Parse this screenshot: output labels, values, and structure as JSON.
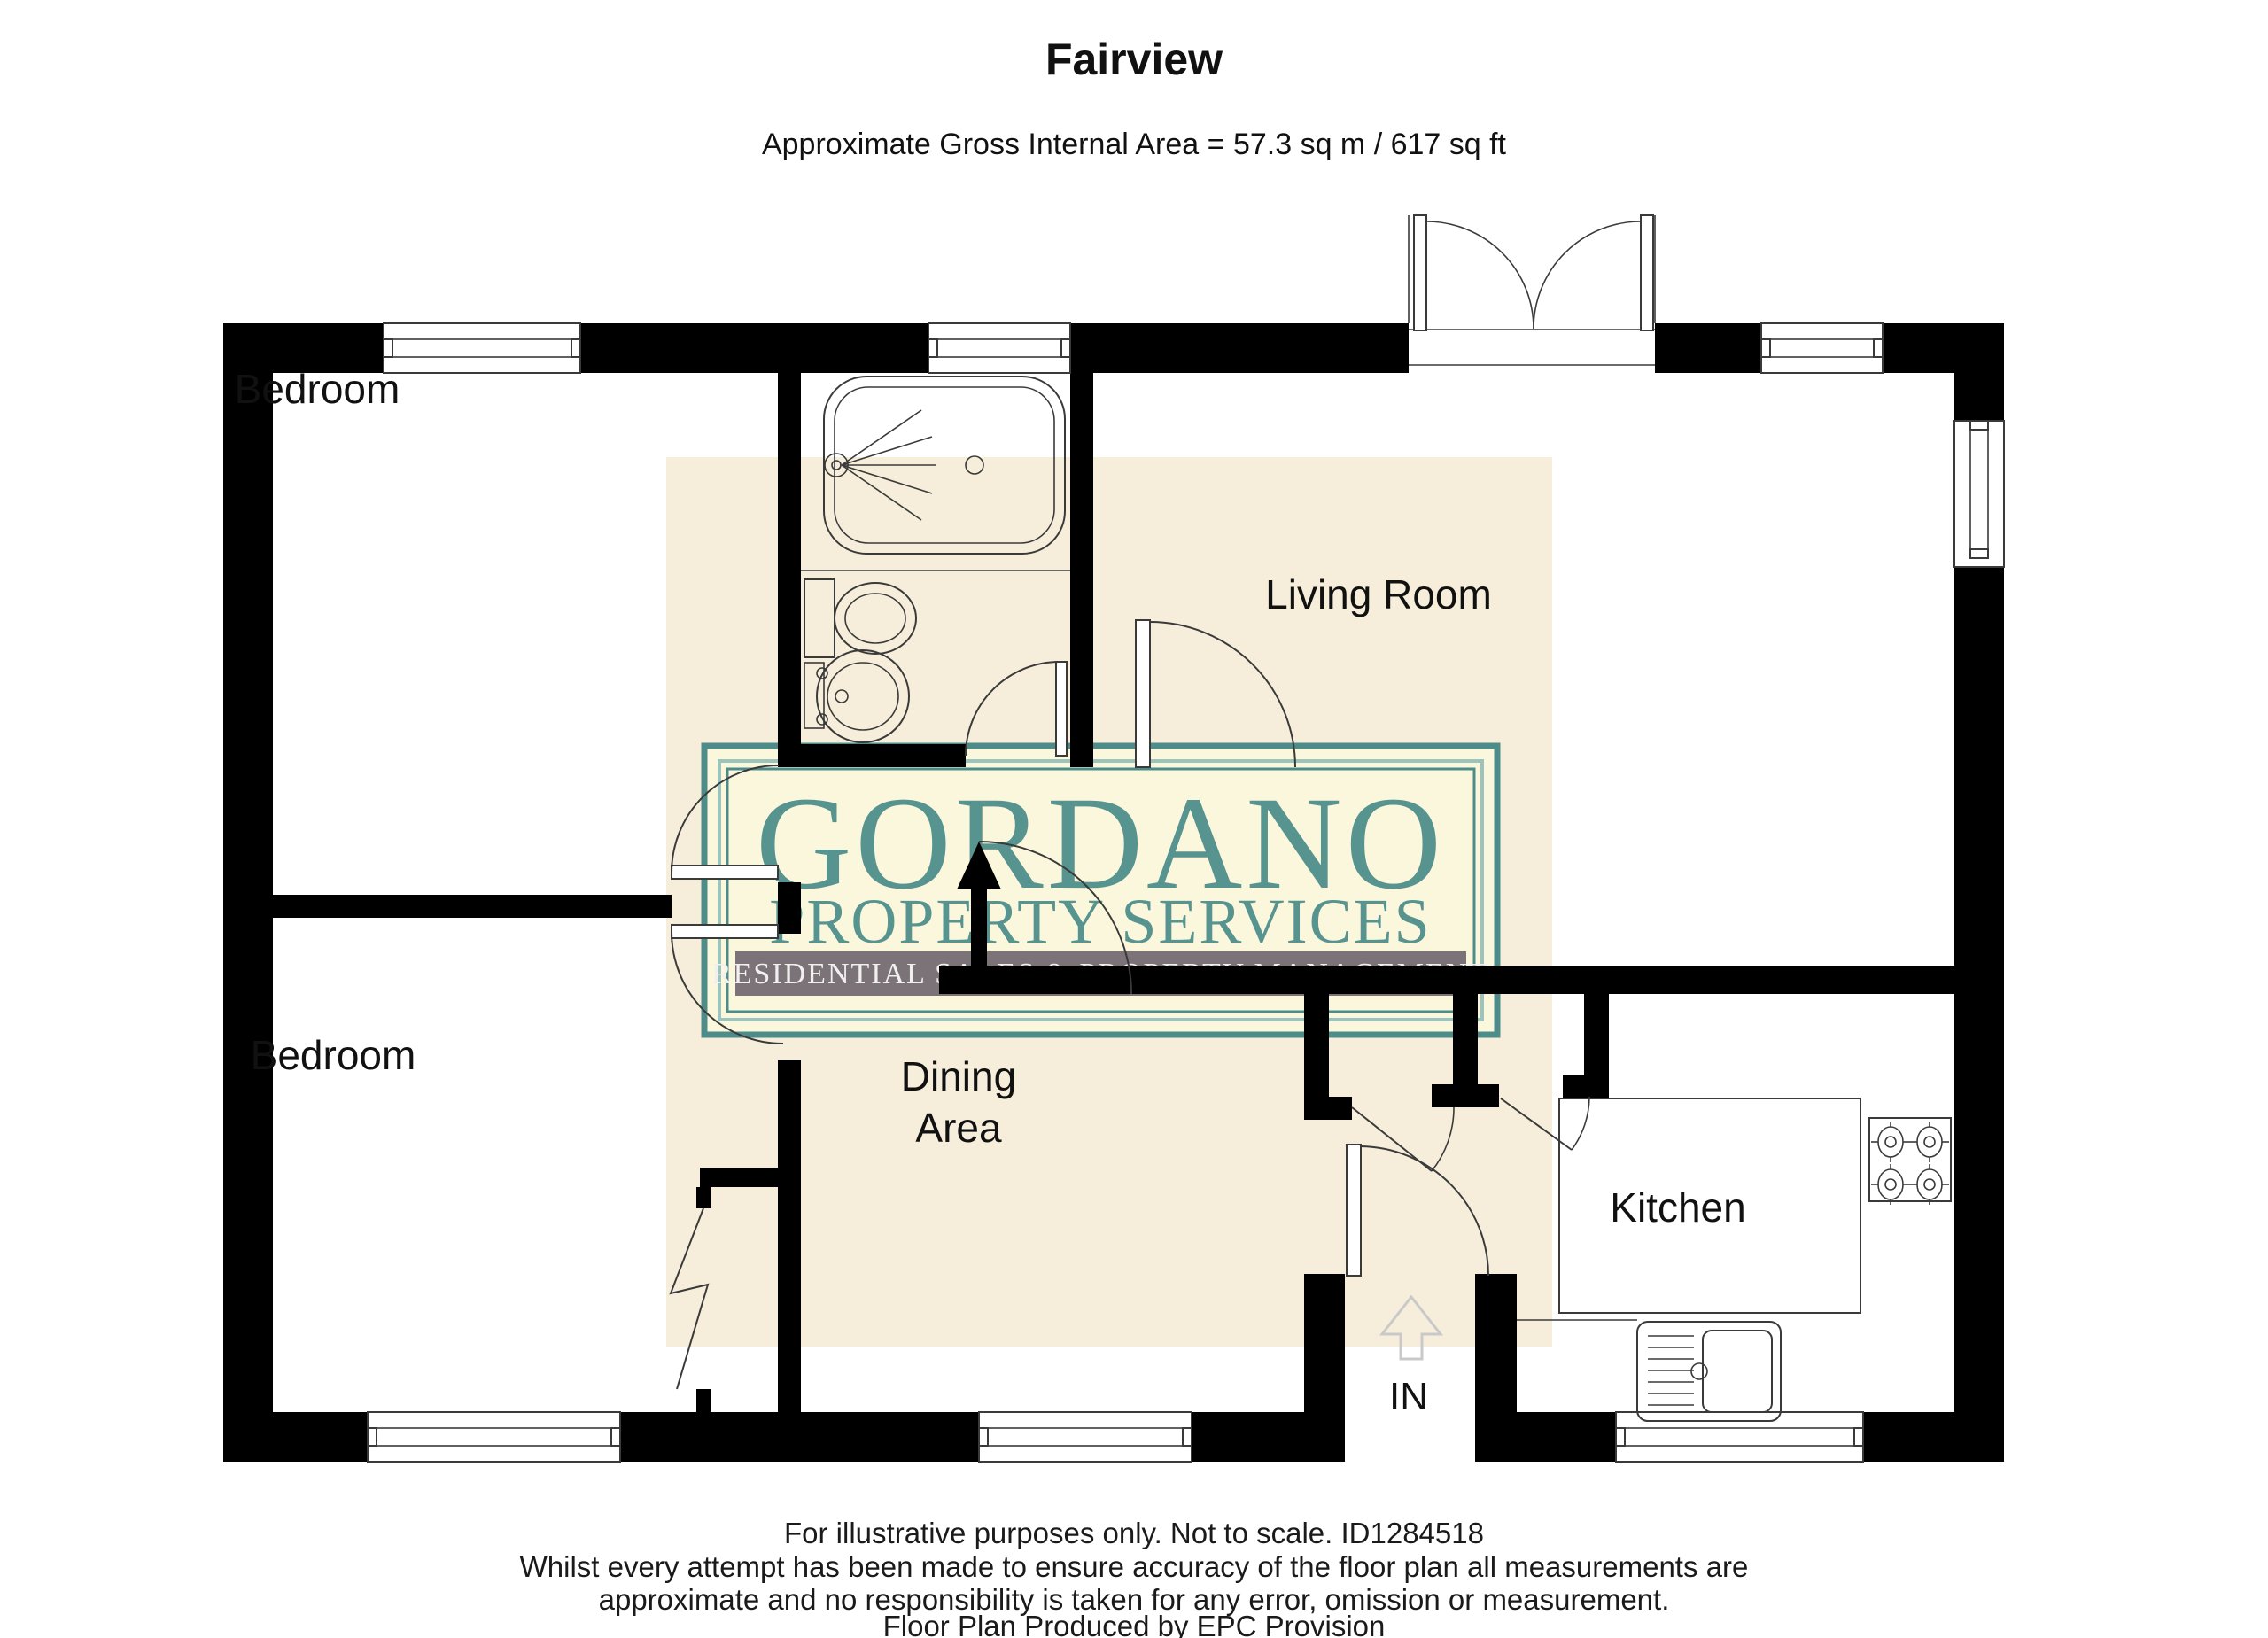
{
  "title": "Fairview",
  "subtitle": "Approximate Gross Internal Area = 57.3 sq m / 617 sq ft",
  "rooms": {
    "bedroom_top": "Bedroom",
    "bedroom_bottom": "Bedroom",
    "living_room": "Living Room",
    "dining_line1": "Dining",
    "dining_line2": "Area",
    "kitchen": "Kitchen",
    "entrance": "IN"
  },
  "watermark": {
    "name": "GORDANO",
    "tagline": "PROPERTY SERVICES",
    "banner": "RESIDENTIAL SALES & PROPERTY MANAGEMENT"
  },
  "footer": {
    "line1": "For illustrative purposes only. Not to scale. ID1284518",
    "line2": "Whilst every attempt has been made to ensure accuracy of the floor plan all measurements are",
    "line3": "approximate and no responsibility is taken for any error, omission or measurement.",
    "line4": "Floor Plan Produced by EPC Provision"
  },
  "colors": {
    "wall": "#000000",
    "line": "#3a3a3a",
    "watermark_background": "#f6eeda",
    "logo_background": "#fbf7dd",
    "logo_teal": "#57948f",
    "logo_border": "#4e8c89",
    "logo_border_light": "#9cc4bd",
    "banner_background": "#7b7377",
    "banner_text": "#f2efef",
    "direction_arrow": "#c9c9c9"
  }
}
